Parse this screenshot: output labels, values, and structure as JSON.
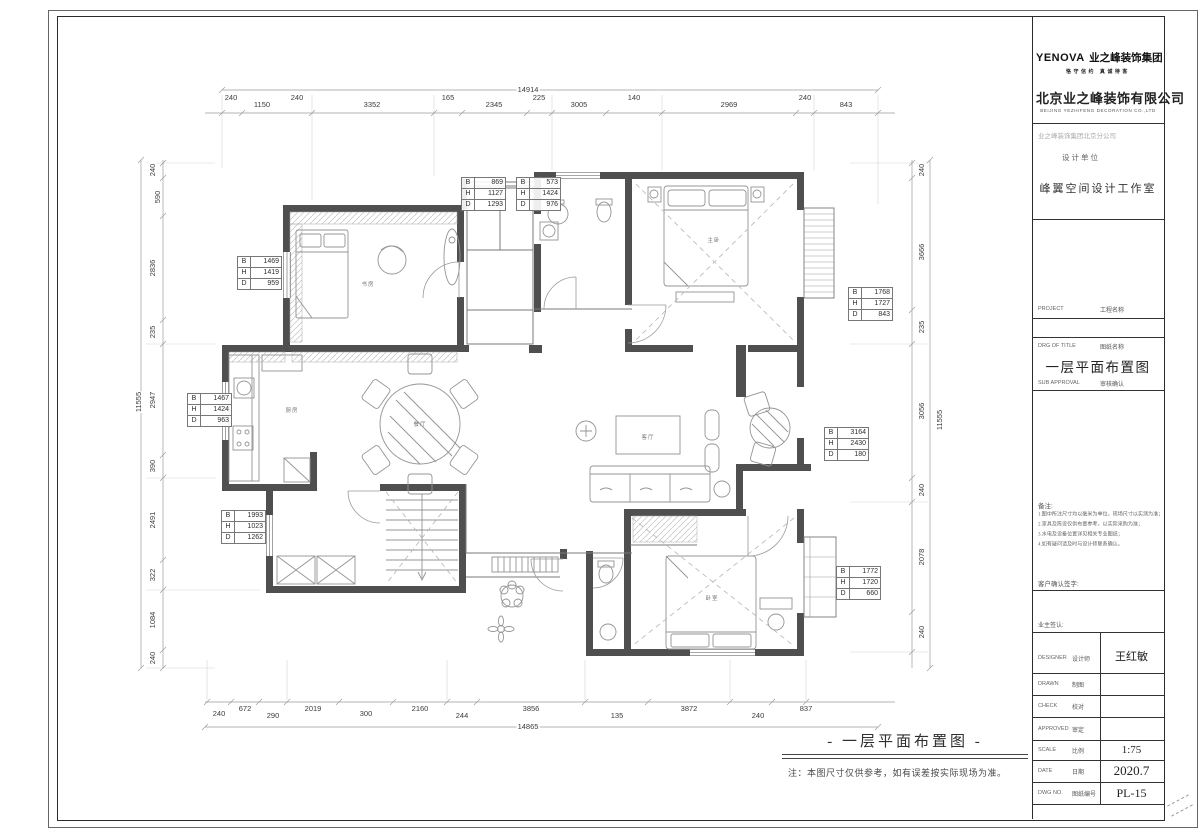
{
  "titleblock": {
    "logo_brand": "YENOVA",
    "logo_cn": "业之峰装饰集团",
    "logo_tagline": "恪守信约 真诚待客",
    "company_name": "北京业之峰装饰有限公司",
    "company_en": "BEIJING YEZHIFENG DECORATION CO.,LTD",
    "branch": "业之峰装饰集团北京分公司",
    "design_unit_label": "设计单位",
    "studio": "峰翼空间设计工作室",
    "project_label_en": "PROJECT",
    "project_label_cn": "工程名称",
    "drg_label_en": "DRG OF TITLE",
    "drg_label_cn": "图纸名称",
    "drawing_title": "一层平面布置图",
    "approval_label_en": "SUB APPROVAL",
    "approval_label_cn": "审核确认",
    "notes_label": "备注:",
    "notes_lines": [
      "1.图中所注尺寸均以毫米为单位，现场尺寸以实测为准；",
      "2.家具及陈设仅供布置参考，以实际采购为准；",
      "3.水电及设备位置详见相关专业图纸；",
      "4.如有疑问请及时与设计师联系确认。"
    ],
    "sign_label": "客户确认签字:",
    "owner_sign_label": "业主签认:",
    "rows": [
      {
        "en": "DESIGNER",
        "cn": "设计师",
        "value": "王红敏"
      },
      {
        "en": "DRAWN",
        "cn": "制图",
        "value": ""
      },
      {
        "en": "CHECK",
        "cn": "校对",
        "value": ""
      },
      {
        "en": "APPROVED",
        "cn": "审定",
        "value": ""
      },
      {
        "en": "SCALE",
        "cn": "比例",
        "value": "1:75"
      },
      {
        "en": "DATE",
        "cn": "日期",
        "value": "2020.7"
      },
      {
        "en": "DWG NO.",
        "cn": "图纸编号",
        "value": "PL-15"
      }
    ]
  },
  "plan": {
    "caption": "- 一层平面布置图 -",
    "note": "注：本图尺寸仅供参考，如有误差按实际现场为准。",
    "win_labels": [
      "B",
      "H",
      "D"
    ],
    "windows": [
      {
        "b": "1469",
        "h": "1419",
        "d": "959"
      },
      {
        "b": "869",
        "h": "1127",
        "d": "1293"
      },
      {
        "b": "573",
        "h": "1424",
        "d": "976"
      },
      {
        "b": "1768",
        "h": "1727",
        "d": "843"
      },
      {
        "b": "1467",
        "h": "1424",
        "d": "963"
      },
      {
        "b": "3164",
        "h": "2430",
        "d": "180"
      },
      {
        "b": "1993",
        "h": "1023",
        "d": "1262"
      },
      {
        "b": "1772",
        "h": "1720",
        "d": "660"
      }
    ],
    "rooms": {
      "study": "书房",
      "master": "主卧",
      "dining": "餐厅",
      "living": "客厅",
      "kitchen": "厨房",
      "bedroom": "卧室"
    },
    "dims": {
      "top_total": "14914",
      "top": [
        "240",
        "1150",
        "240",
        "3352",
        "165",
        "2345",
        "225",
        "3005",
        "140",
        "2969",
        "240",
        "843"
      ],
      "bottom_total": "14865",
      "bottom": [
        "240",
        "672",
        "290",
        "2019",
        "300",
        "2160",
        "244",
        "3856",
        "135",
        "3872",
        "240",
        "837"
      ],
      "left_total": "11555",
      "left": [
        "240",
        "590",
        "2836",
        "235",
        "2947",
        "390",
        "2491",
        "322",
        "1084",
        "240"
      ],
      "right_total": "11555",
      "right": [
        "240",
        "3666",
        "235",
        "3056",
        "240",
        "2078",
        "240"
      ]
    }
  }
}
